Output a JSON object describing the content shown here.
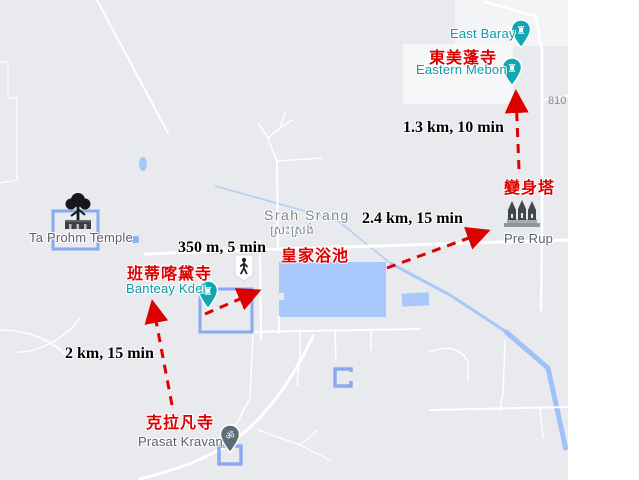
{
  "colors": {
    "map_background": "#e8eaed",
    "water": "#a8c7fa",
    "temple_outline_blue": "#89a9f2",
    "annotation_red": "#dd0000",
    "poi_teal": "#0d99a8",
    "pin_teal": "#12a5b4",
    "pin_gray": "#5d6b76"
  },
  "places": {
    "east_baray": {
      "name": "East Baray"
    },
    "eastern_mebon": {
      "name": "Eastern Mebon",
      "zh": "東美蓬寺"
    },
    "pre_rup": {
      "name": "Pre Rup",
      "zh": "變身塔"
    },
    "srah_srang": {
      "name": "Srah Srang",
      "khmer": "ស្រះស្រង់",
      "zh": "皇家浴池"
    },
    "banteay_kdei": {
      "name": "Banteay Kdei",
      "zh": "班蒂喀黛寺"
    },
    "ta_prohm": {
      "name": "Ta Prohm Temple"
    },
    "prasat_kravan": {
      "name": "Prasat Kravan",
      "zh": "克拉凡寺"
    }
  },
  "legs": [
    {
      "distance": "2 km, 15 min"
    },
    {
      "distance": "350 m, 5 min"
    },
    {
      "distance": "2.4 km, 15 min"
    },
    {
      "distance": "1.3 km, 10 min"
    }
  ],
  "road": {
    "number": "810"
  },
  "icons": {
    "temple_pin_glyph": "♜",
    "om_glyph": "ॐ"
  }
}
